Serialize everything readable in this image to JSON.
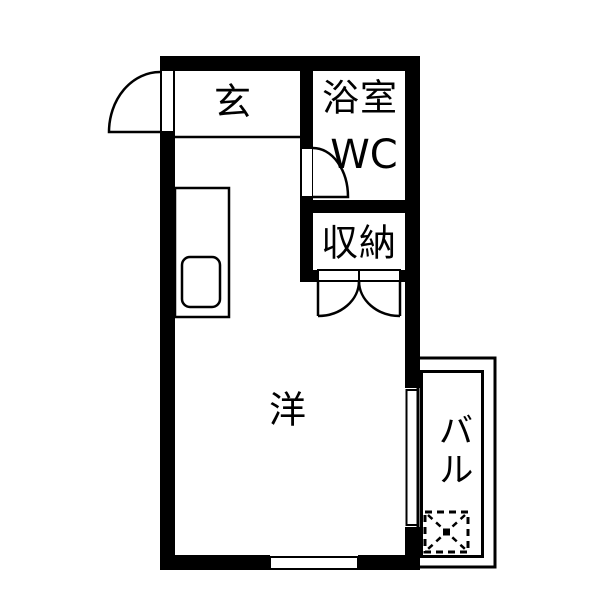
{
  "document": {
    "kind": "apartment-floor-plan"
  },
  "colors": {
    "wall": "#000000",
    "line": "#000000",
    "background": "#ffffff",
    "text": "#000000"
  },
  "rooms": {
    "genkan": {
      "label": "玄"
    },
    "bathroom": {
      "label": "浴室"
    },
    "wc": {
      "label": "WC"
    },
    "closet": {
      "label": "収納"
    },
    "western_room": {
      "label": "洋"
    },
    "balcony": {
      "label": "バル"
    }
  },
  "symbols": {
    "entrance_door": "swing-door-arc",
    "bathroom_door": "swing-door-arc",
    "closet_doors": "double-swing-door-arcs",
    "kitchen_counter": "counter-with-sink",
    "washing_machine": "dashed-square-with-x",
    "main_window": "wall-window",
    "balcony_window": "wall-window"
  }
}
